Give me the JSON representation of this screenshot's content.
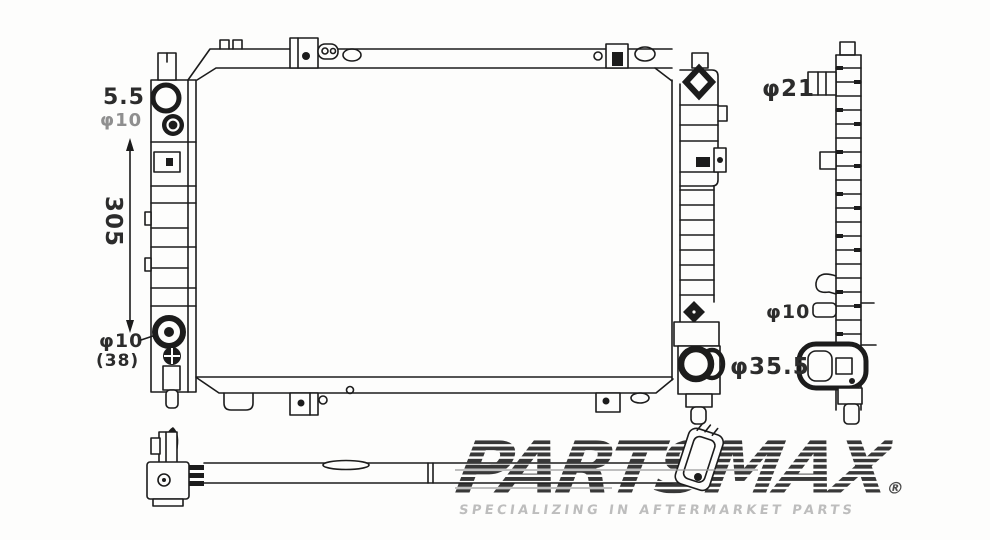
{
  "page": {
    "background": "#fdfdfc",
    "ink": "#1c1c1c"
  },
  "diagram": {
    "subject": "radiator-three-view-technical-drawing",
    "views": {
      "front": "front-view",
      "side": "side-view",
      "bottom": "bottom-view"
    },
    "annotations": {
      "top_left_thickness": "5.5",
      "top_left_diameter": "φ10",
      "core_height": "305",
      "bottom_left_diameter": "φ10",
      "bottom_left_note": "(38)",
      "inlet_diameter": "φ21",
      "side_small_diameter": "φ10",
      "outlet_diameter": "φ35.5"
    }
  },
  "watermark": {
    "brand": "PARTSMAX",
    "registered": "®",
    "tagline": "SPECIALIZING IN AFTERMARKET PARTS",
    "brand_color": "#3d3d3d",
    "tagline_color": "#bdbdbd"
  }
}
